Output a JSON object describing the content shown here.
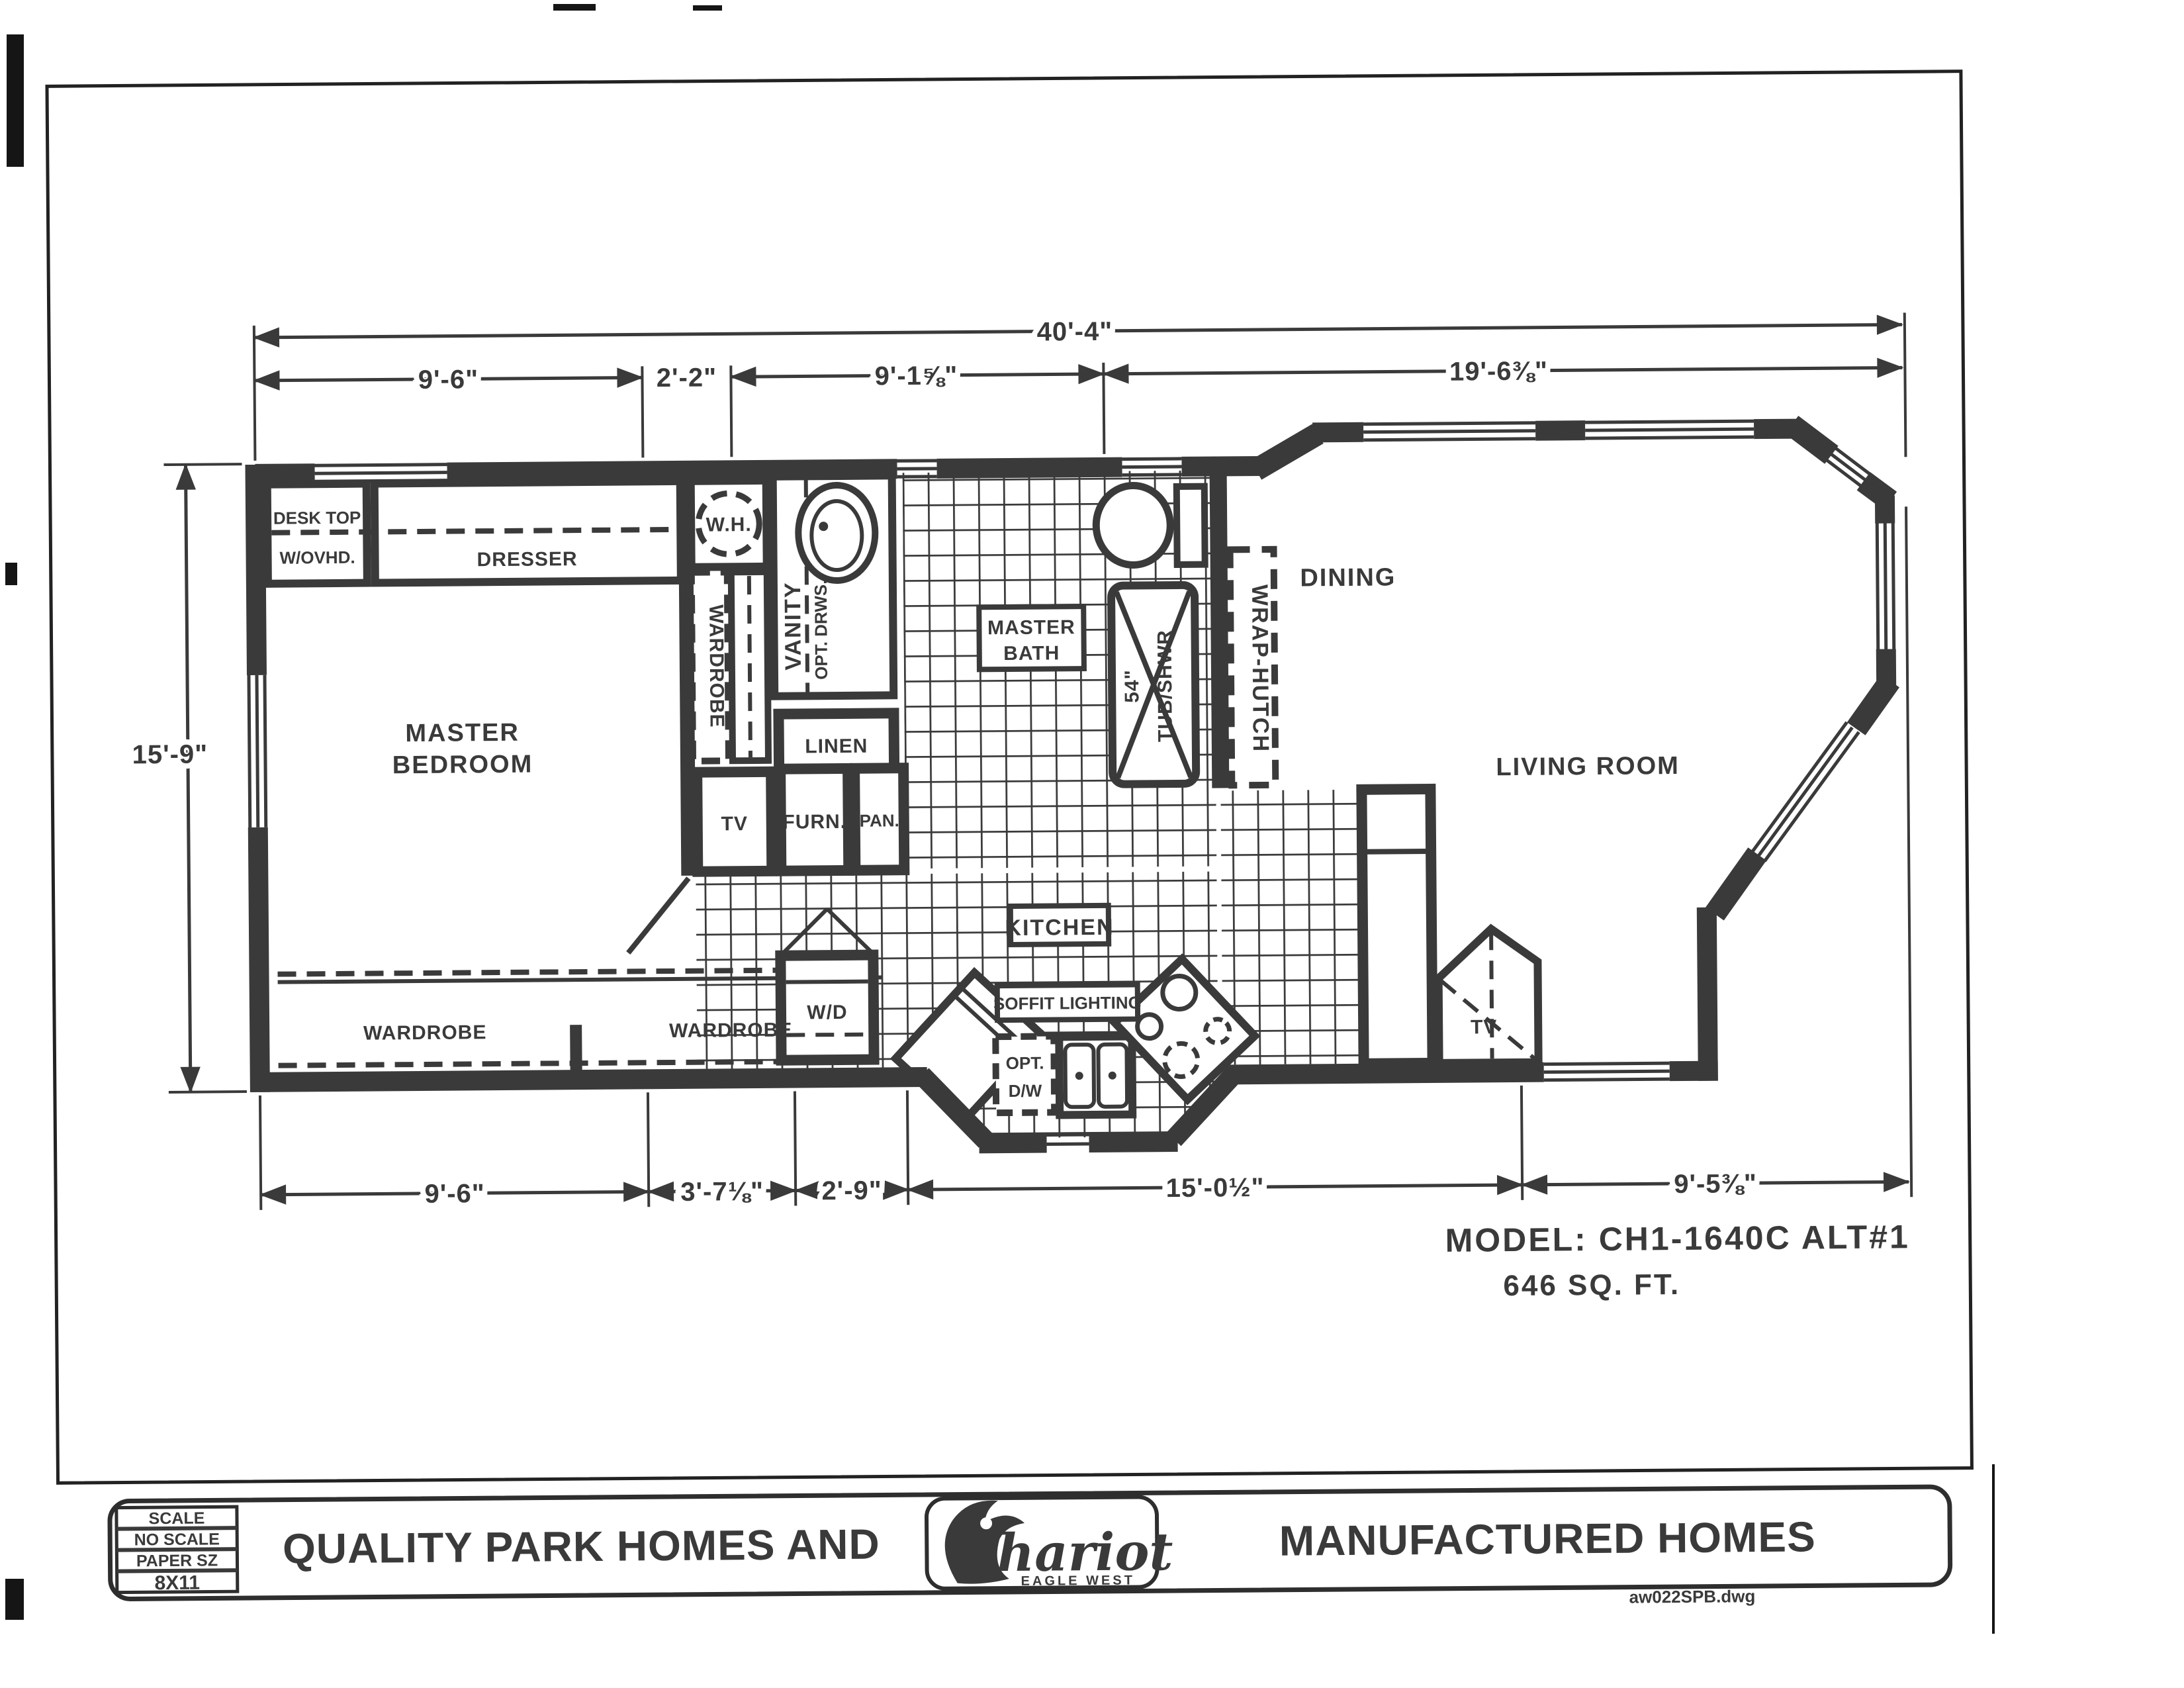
{
  "dims": {
    "overall": "40'-4\"",
    "top": [
      "9'-6\"",
      "2'-2\"",
      "9'-1⅝\"",
      "19'-6⅜\""
    ],
    "left": "15'-9\"",
    "bottom": [
      "9'-6\"",
      "3'-7⅛\"",
      "2'-9\"",
      "15'-0½\"",
      "9'-5⅜\""
    ]
  },
  "labels": {
    "desk_line1": "DESK TOP",
    "desk_line2": "W/OVHD.",
    "dresser": "DRESSER",
    "water_heater": "W.H.",
    "wardrobe_vertical": "WARDROBE",
    "vanity": "VANITY",
    "vanity_opt": "OPT. DRWS.",
    "linen": "LINEN",
    "tv_closet": "TV",
    "furnace": "FURN.",
    "pantry": "PAN.",
    "tub_size": "54\"",
    "tub_name": "TUB/SHWR",
    "wrap_hutch": "WRAP-HUTCH",
    "master_bedroom_line1": "MASTER",
    "master_bedroom_line2": "BEDROOM",
    "master_bath_line1": "MASTER",
    "master_bath_line2": "BATH",
    "wardrobe_left": "WARDROBE",
    "wardrobe_right": "WARDROBE",
    "washer_dryer": "W/D",
    "kitchen": "KITCHEN",
    "soffit": "SOFFIT LIGHTING",
    "dw_line1": "OPT.",
    "dw_line2": "D/W",
    "dining": "DINING",
    "living_room": "LIVING ROOM",
    "tv_living": "TV"
  },
  "model": {
    "line1": "MODEL: CH1-1640C ALT#1",
    "line2": "646 SQ. FT."
  },
  "title_block": {
    "scale_label": "SCALE",
    "scale_value": "NO SCALE",
    "paper_label": "PAPER SZ",
    "paper_value": "8X11",
    "company_left": "QUALITY PARK HOMES AND",
    "company_right": "MANUFACTURED HOMES",
    "logo_text": "Chariot",
    "logo_subtext": "EAGLE WEST",
    "file_name": "aw022SPB.dwg"
  }
}
